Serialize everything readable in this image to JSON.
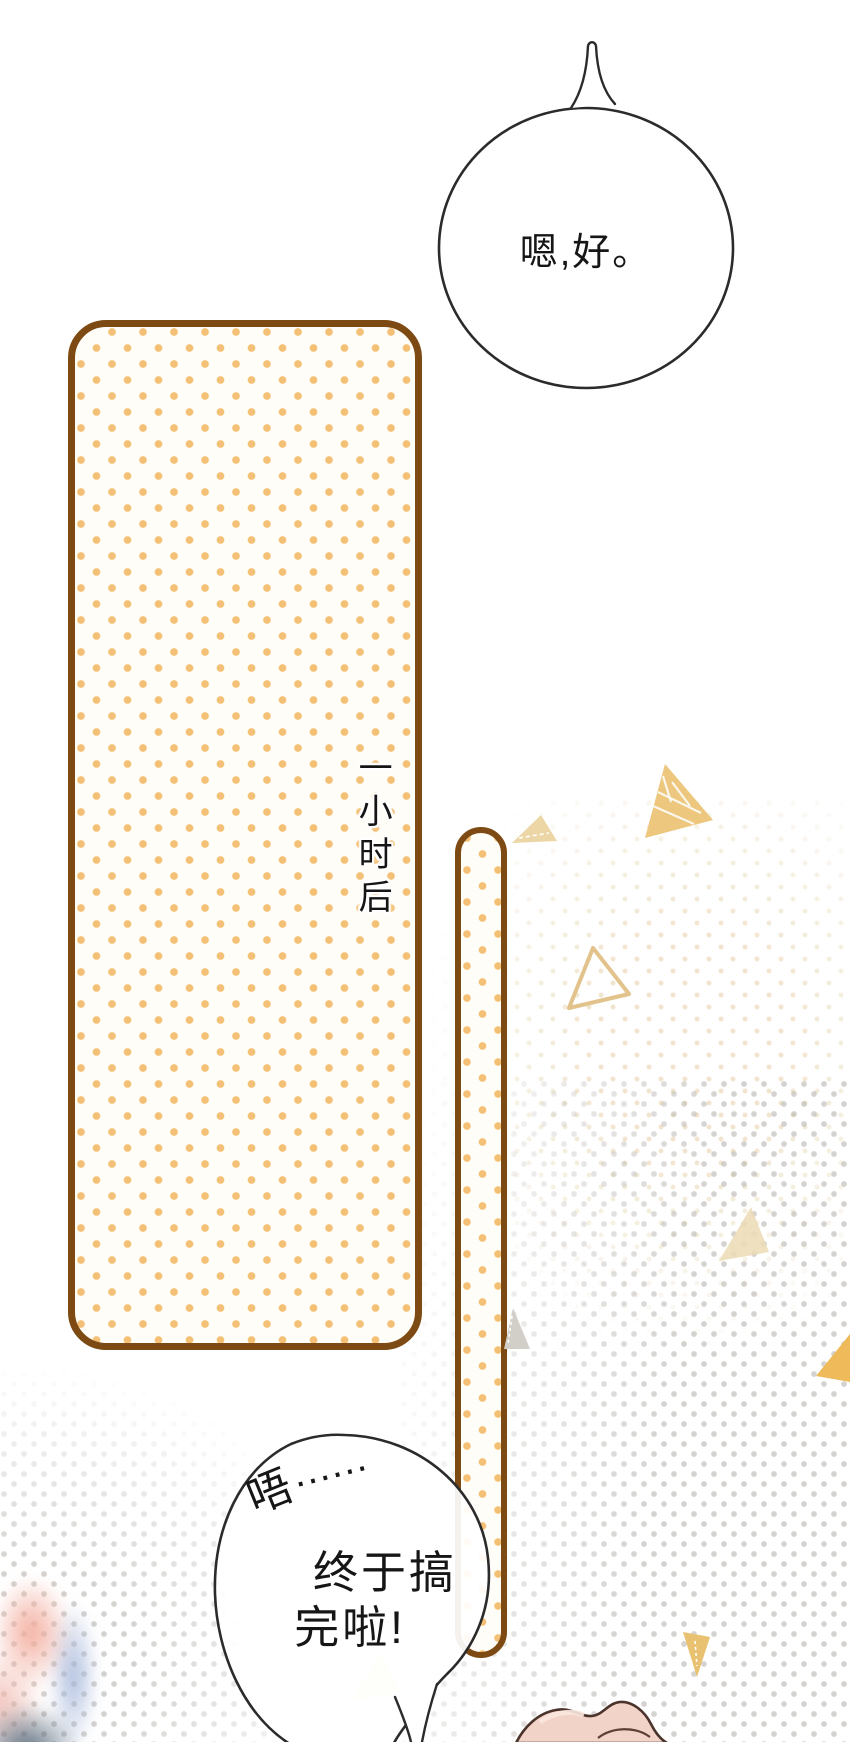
{
  "page": {
    "kind": "comic-page",
    "width_px": 850,
    "height_px": 1742,
    "background": "#ffffff"
  },
  "speech_bubbles": {
    "top": {
      "text": "嗯,好。"
    },
    "bottom": {
      "murmur": "唔",
      "murmur_dots": "……",
      "line1": "终于搞",
      "line2": "完啦!"
    }
  },
  "captions": {
    "time_vertical": "一小时后"
  },
  "colors": {
    "panel_border_brown": "#7c4a12",
    "polka_dot_orange": "#f4c076",
    "panel_fill": "#fffdf7",
    "bubble_outline": "#2b2b2b",
    "triangle_gold": "#ecc77d",
    "triangle_tan": "#edd6a5",
    "triangle_outline_tan": "#e2c38b",
    "triangle_gray": "#d2cfc9",
    "triangle_deep_gold": "#efba59",
    "skin_fill": "#f1d3c8",
    "skin_outline": "#4a332b",
    "halftone_gray": "#b8b5b0",
    "halftone_cream": "#ecdec1"
  },
  "decorations": [
    "gold-sketch-triangle",
    "tan-triangle-small",
    "tan-outline-triangle",
    "gray-stitch-triangle",
    "gold-triangle-right-edge",
    "tan-triangle-right-edge",
    "gold-triangle-down",
    "cream-triangle-behind-bubble",
    "blurred-foreground-object",
    "hand-shape-bottom"
  ]
}
